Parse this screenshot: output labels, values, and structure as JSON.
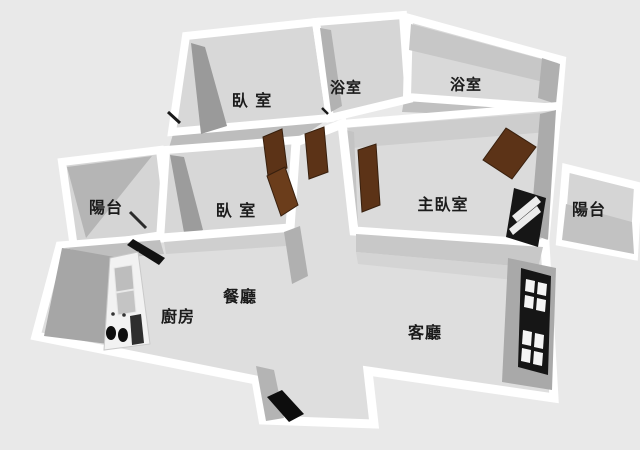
{
  "scene": {
    "type": "floor-plan-3d-render",
    "background": "#e9e9e9"
  },
  "palette": {
    "wall": "#ffffff",
    "floor": "#dcdcdc",
    "wall_shadow": "#a6a6a6",
    "door_wood": "#5c3317",
    "window_frame": "#161616",
    "label_text": "#1b1b1b"
  },
  "rooms": [
    {
      "id": "bedroom-1",
      "label": "臥 室"
    },
    {
      "id": "bathroom-1",
      "label": "浴室"
    },
    {
      "id": "bathroom-2",
      "label": "浴室"
    },
    {
      "id": "balcony-left",
      "label": "陽台"
    },
    {
      "id": "bedroom-2",
      "label": "臥 室"
    },
    {
      "id": "master-bedroom",
      "label": "主臥室"
    },
    {
      "id": "balcony-right",
      "label": "陽台"
    },
    {
      "id": "dining-room",
      "label": "餐廳"
    },
    {
      "id": "kitchen",
      "label": "廚房"
    },
    {
      "id": "living-room",
      "label": "客廳"
    }
  ]
}
